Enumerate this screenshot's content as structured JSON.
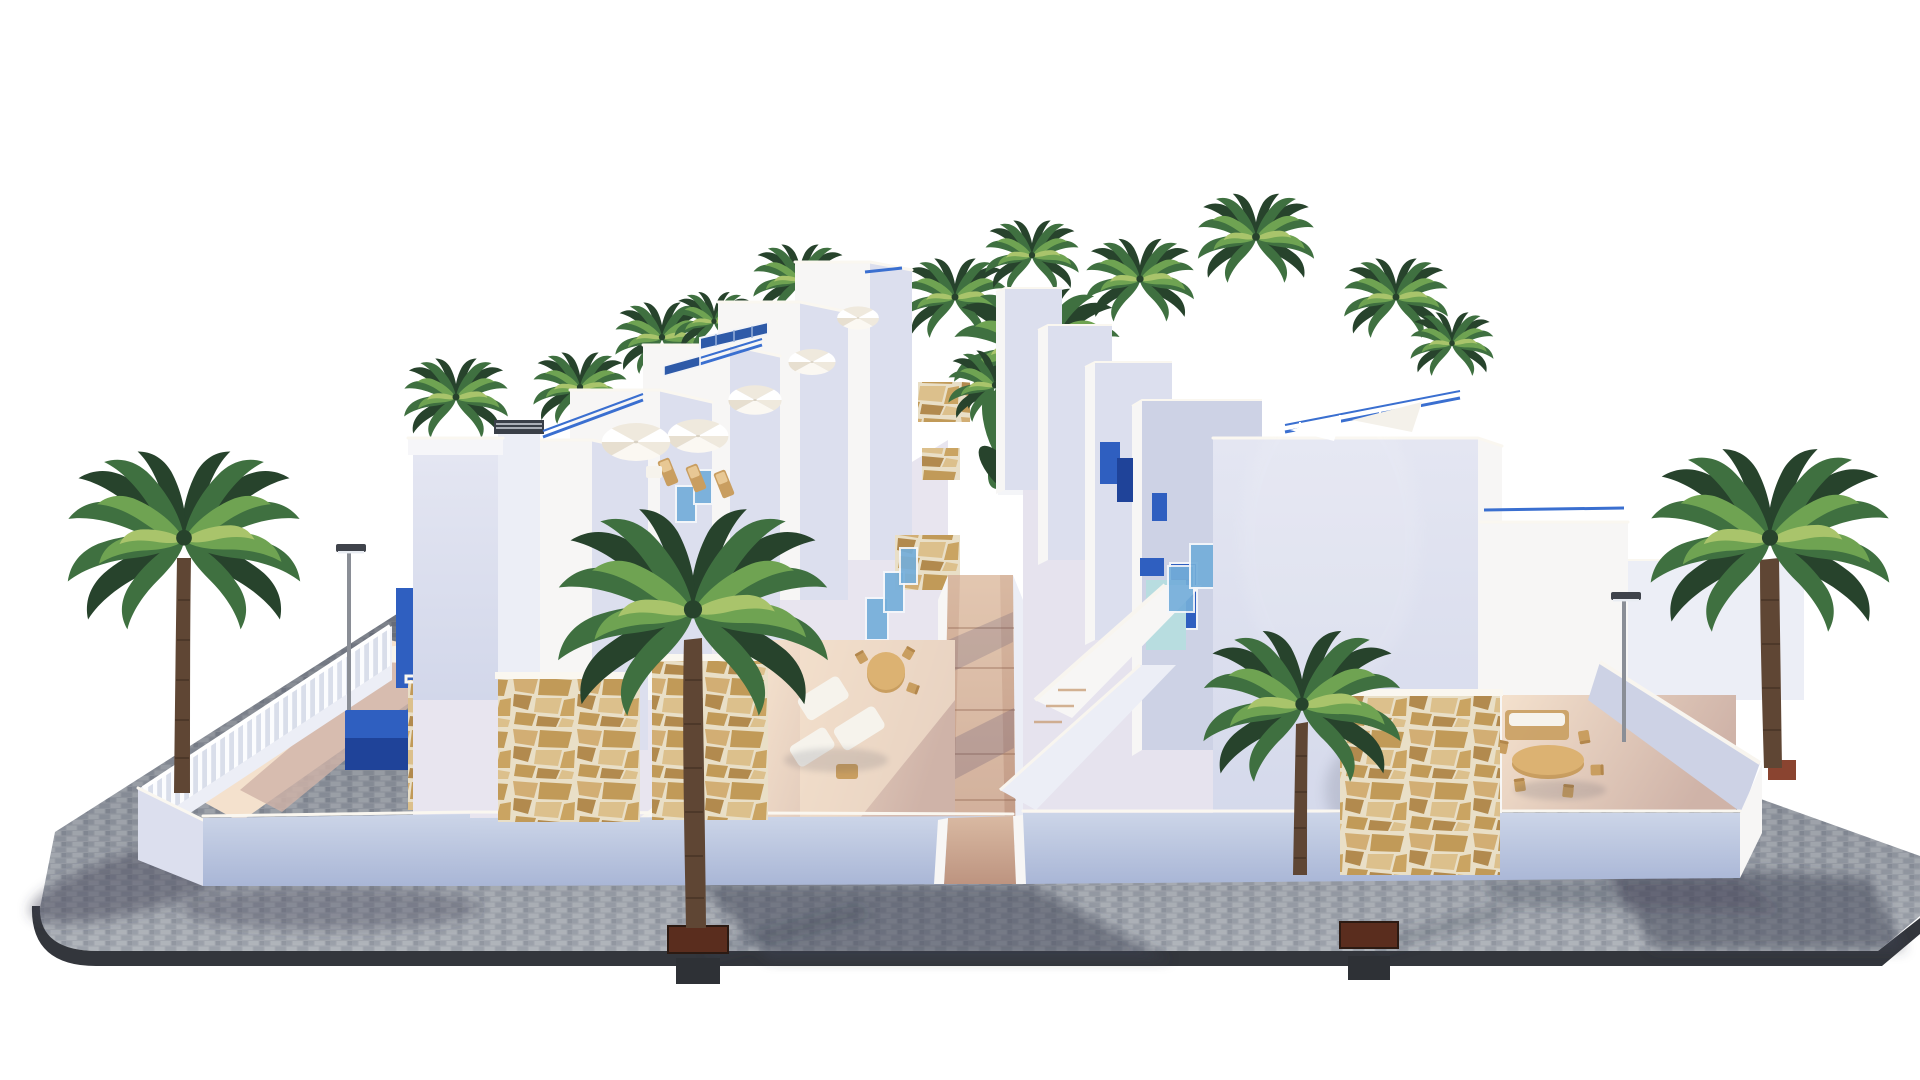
{
  "scene": {
    "title": "New-build seafront apartment complex - exterior 3D render",
    "description": "Aerial front view 3D architectural render of a modern white Mediterranean residential complex on a white background: two rows of stepped townhouses with roof terraces face a central pedestrian walkway with a landscaped garden, pergola and pool. The facades have cobalt-blue shutters and doors, light-blue glass balustrades, rustic stone-clad wall panels and white parasols with sun loungers. Four tall palm trees stand in front of the complex on a gray brick-paved plaza with a rounded curb, two recessed tree planters and two slim street lamps; long soft shadows fall to the lower right.",
    "style": "photorealistic render, isolated on white",
    "time_of_day": "sunny daytime, sun from upper left"
  },
  "objects": {
    "building_rows": 2,
    "foreground_palm_trees": 4,
    "rooftop_palm_trees": 11,
    "street_lamps": 2,
    "curb_tree_planters": 2,
    "parasols": 6,
    "stone_clad_panels": 7,
    "roof_solar_panels": 2,
    "central_walkway": "ramped paved path between the two rows",
    "garden": "banana plants, palm, white pergola, lawn, plunge pool",
    "furniture": "outdoor lounge set, round and oval dining tables with chairs, sun loungers"
  },
  "colors": {
    "sky": "#ffffff",
    "pav_base": "#989da6",
    "pav_light": "#a6abb2",
    "pav_mid": "#8f959f",
    "pav_dark": "#848a95",
    "curb": "#33363c",
    "wall_lit": "#f7f6f5",
    "wall_soft": "#eceef6",
    "wall_shade": "#dcdfee",
    "wall_deep": "#cdd2e5",
    "coping": "#faf7f0",
    "plinth_top": "#ccd5e8",
    "plinth_bot": "#a9b6d6",
    "terrace_lit": "#f4e1cd",
    "terrace_shade": "#cfb3a8",
    "path_top": "#d9b9a2",
    "path_bot": "#bd9480",
    "accent_blue": "#2f5fc0",
    "accent_blue_dark": "#1f4399",
    "glass_blue": "#74aeda",
    "aqua": "#b8dde0",
    "rail_blue": "#3a6fd0",
    "palm_dark": "#27432c",
    "palm_mid": "#3f7040",
    "palm_light": "#6fa352",
    "palm_hi": "#a9c46b",
    "trunk": "#5f4634",
    "trunk_dark": "#38291d",
    "soil": "#5a2d1e",
    "pot": "#8a4430",
    "furniture_wood": "#c99e60",
    "cushion": "#f6f3ec",
    "lawn": "#55893a",
    "pool": "#cfe8ec",
    "shadow": "#3d4254",
    "stone_grout": "#e9dfc7",
    "stone_1": "#d2ae74",
    "stone_2": "#c19a58",
    "stone_3": "#b28a4e",
    "stone_4": "#dcc08c",
    "stone_5": "#caa462",
    "lamp": "#8a8e96",
    "lamp_head": "#3f434b",
    "louver": "#3a3f48"
  }
}
